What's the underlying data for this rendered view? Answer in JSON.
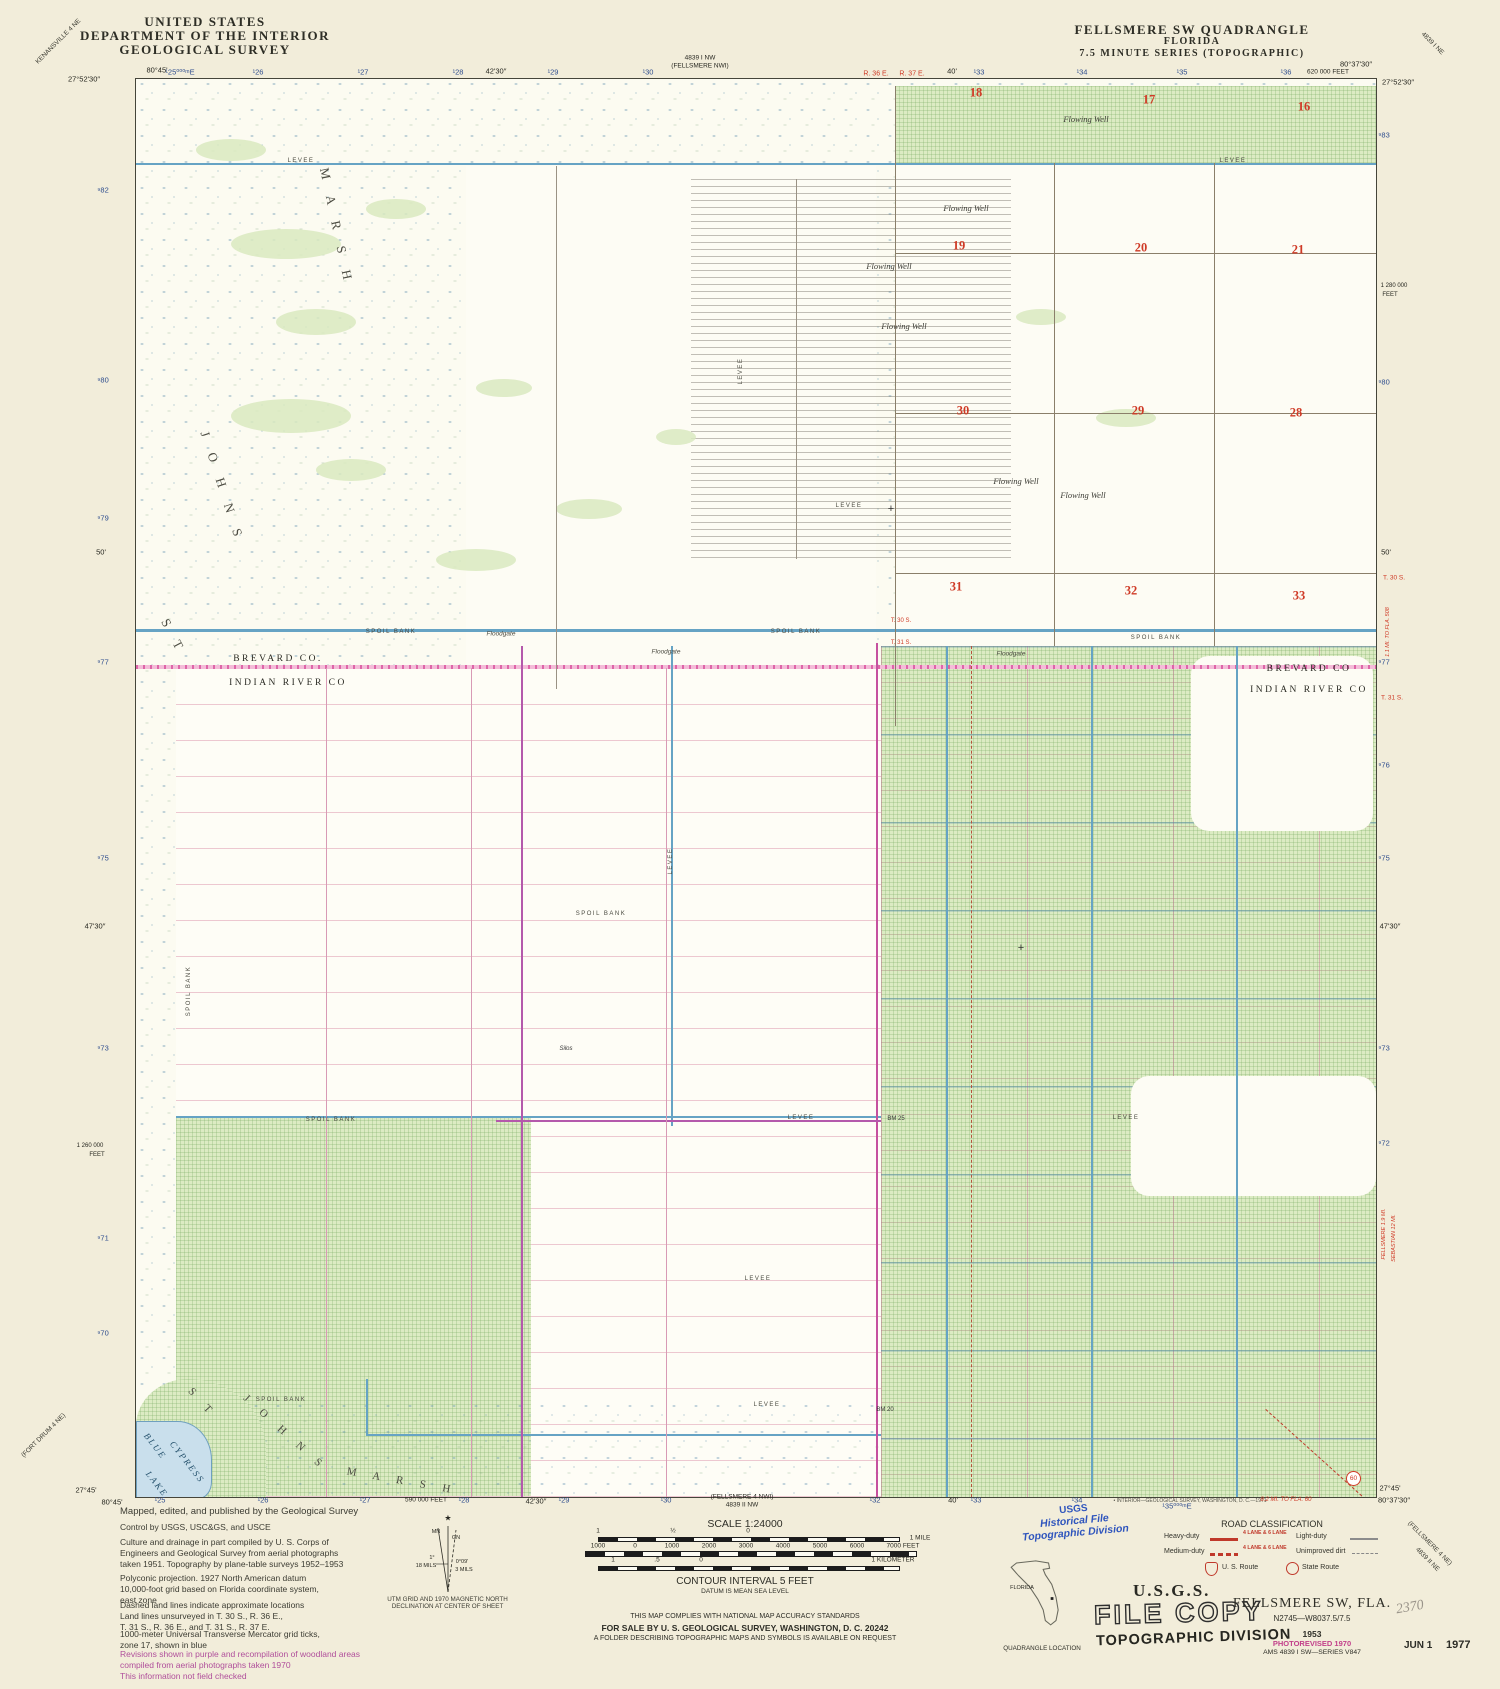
{
  "header_left": {
    "l1": "UNITED STATES",
    "l2": "DEPARTMENT OF THE INTERIOR",
    "l3": "GEOLOGICAL SURVEY"
  },
  "header_right": {
    "l1": "FELLSMERE SW QUADRANGLE",
    "l2": "FLORIDA",
    "l3": "7.5 MINUTE SERIES (TOPOGRAPHIC)"
  },
  "corner_quads": {
    "tl": "KENANSVILLE 4 NE",
    "tr": "4839 I NE",
    "bl": "(FORT DRUM 4 NE)",
    "br1": "(FELLSMERE 4 NE)",
    "br2": "4839 II NE"
  },
  "top_ticks": [
    "80°45'",
    "¹25⁰⁰⁰ᵐE",
    "¹26",
    "¹27",
    "¹28",
    "42'30″",
    "¹29",
    "¹30",
    "4839 I NW",
    "(FELLSMERE NWI)",
    "R. 36 E.",
    "R. 37 E.",
    "40'",
    "¹33",
    "¹34",
    "¹35",
    "¹36",
    "620 000 FEET",
    "80°37'30″",
    "27°52'30″",
    "27°52'30″"
  ],
  "bottom_ticks": [
    "27°45'",
    "80°45'",
    "¹25",
    "¹26",
    "¹27",
    "590 000 FEET",
    "¹28",
    "42'30″",
    "¹29",
    "¹30",
    "(FELLSMERE 4 NWI)",
    "4839 II NW",
    "¹32",
    "40'",
    "¹33",
    "¹34",
    "¹35⁰⁰⁰ᵐE",
    "• INTERIOR—GEOLOGICAL SURVEY, WASHINGTON, D. C.—1971",
    "8.2 MI. TO FLA. 60",
    "27°45'",
    "80°37'30″"
  ],
  "left_ticks": [
    "⁹82",
    "⁹80",
    "⁹79",
    "50'",
    "⁹77",
    "⁹75",
    "47'30″",
    "⁹73",
    "1 260 000",
    "FEET",
    "⁹71",
    "⁹70"
  ],
  "right_ticks": [
    "⁹83",
    "1 280 000",
    "FEET",
    "⁹80",
    "50'",
    "⁹77",
    "⁹76",
    "⁹75",
    "47'30″",
    "⁹73",
    "⁹72"
  ],
  "right_red": [
    "T. 30 S.",
    "1.1 MI. TO FLA. 508",
    "T. 31 S.",
    "FELLSMERE 1.9 MI.",
    "SEBASTIAN 12 MI."
  ],
  "sections": [
    "18",
    "17",
    "16",
    "19",
    "20",
    "21",
    "30",
    "29",
    "28",
    "31",
    "32",
    "33"
  ],
  "map_labels": {
    "flowing_well": "Flowing Well",
    "levee": "LEVEE",
    "spoil_bank": "SPOIL BANK",
    "floodgate": "Floodgate",
    "brevard_left": "BREVARD CO.",
    "indian_left": "INDIAN RIVER CO",
    "brevard_right": "BREVARD CO",
    "indian_right": "INDIAN RIVER CO",
    "t30": "T. 30 S.",
    "t31": "T. 31 S.",
    "st": "S T",
    "johns": "J O H N S",
    "marsh": "M A R S H",
    "blue": "BLUE",
    "cypress": "CYPRESS",
    "lake": "LAKE",
    "bm25": "BM 25",
    "bm20": "BM 20",
    "silos": "Silos",
    "route60": "60"
  },
  "credits": {
    "l1": "Mapped, edited, and published by the Geological Survey",
    "l2": "Control by USGS, USC&GS, and USCE",
    "p3": "Culture and drainage in part compiled by U. S. Corps of\nEngineers and Geological Survey from aerial photographs\ntaken 1951.  Topography by plane-table surveys 1952–1953",
    "p4": "Polyconic projection.  1927 North American datum\n10,000-foot grid based on Florida coordinate system,\neast zone",
    "p5": "Dashed land lines indicate approximate locations\nLand lines unsurveyed in T. 30 S., R. 36 E.,\nT. 31 S., R. 36 E., and T. 31 S., R. 37 E.",
    "p6": "1000-meter Universal Transverse Mercator grid ticks,\nzone 17, shown in blue",
    "p7": "Revisions shown in purple and recompilation of woodland areas\ncompiled from aerial photographs taken 1970\nThis information not field checked"
  },
  "declination": {
    "mn": "MN",
    "gn": "GN",
    "d1": "1°",
    "m1": "18 MILS",
    "d2": "0°09'",
    "m2": "3 MILS",
    "caption": "UTM GRID AND 1970 MAGNETIC NORTH\nDECLINATION AT CENTER OF SHEET"
  },
  "scalebar": {
    "title": "SCALE 1:24000",
    "mile": [
      "1",
      "½",
      "0",
      "1 MILE"
    ],
    "feet": [
      "1000",
      "0",
      "1000",
      "2000",
      "3000",
      "4000",
      "5000",
      "6000",
      "7000 FEET"
    ],
    "km": [
      "1",
      ".5",
      "0",
      "1 KILOMETER"
    ],
    "contour": "CONTOUR INTERVAL 5 FEET",
    "datum": "DATUM IS MEAN SEA LEVEL",
    "compliance": "THIS MAP COMPLIES WITH NATIONAL MAP ACCURACY STANDARDS",
    "sale": "FOR SALE BY U. S. GEOLOGICAL SURVEY, WASHINGTON, D. C. 20242",
    "folder": "A FOLDER DESCRIBING TOPOGRAPHIC MAPS AND SYMBOLS IS AVAILABLE ON REQUEST"
  },
  "road_class": {
    "title": "ROAD CLASSIFICATION",
    "heavy": "Heavy-duty",
    "medium": "Medium-duty",
    "light": "Light-duty",
    "unimproved": "Unimproved dirt",
    "lanes": "4 LANE & 6 LANE",
    "us_route": "U. S. Route",
    "state_route": "State Route"
  },
  "stamps": {
    "usgs": "U.S.G.S.",
    "file_copy": "FILE COPY",
    "topo_div": "TOPOGRAPHIC DIVISION",
    "hist1": "USGS",
    "hist2": "Historical File",
    "hist3": "Topographic Division",
    "date1": "JUN 1",
    "date2": "1977",
    "pencil": "2370"
  },
  "title_block": {
    "name": "FELLSMERE SW, FLA.",
    "coords": "N2745—W8037.5/7.5",
    "year": "1953",
    "photorev": "PHOTOREVISED 1970",
    "ams": "AMS 4839 I SW—SERIES V847"
  },
  "location": {
    "state": "FLORIDA",
    "caption": "QUADRANGLE LOCATION"
  }
}
